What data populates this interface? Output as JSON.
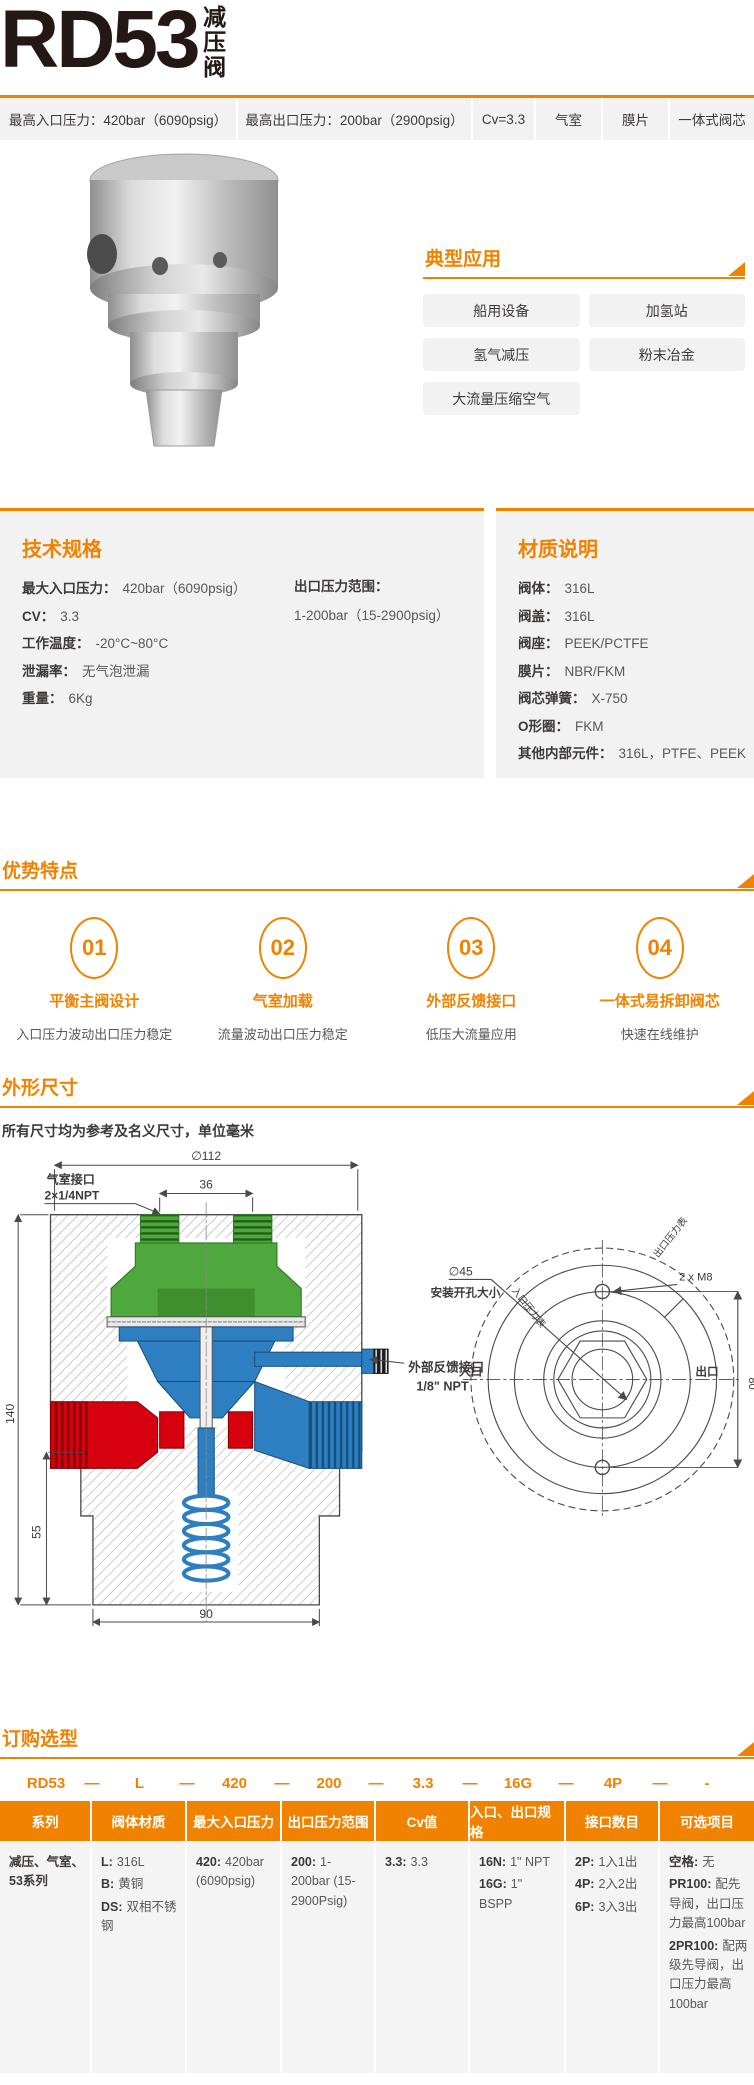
{
  "header": {
    "model": "RD53",
    "product_type": "减压阀"
  },
  "spec_bar": {
    "items": [
      "最高入口压力：420bar（6090psig）",
      "最高出口压力：200bar（2900psig）",
      "Cv=3.3",
      "气室",
      "膜片",
      "一体式阀芯"
    ]
  },
  "applications": {
    "title": "典型应用",
    "items": [
      "船用设备",
      "加氢站",
      "氢气减压",
      "粉末冶金",
      "大流量压缩空气"
    ]
  },
  "tech_specs": {
    "title": "技术规格",
    "items": [
      {
        "label": "最大入口压力：",
        "value": "420bar（6090psig）"
      },
      {
        "label": "CV：",
        "value": "3.3"
      },
      {
        "label": "工作温度：",
        "value": "-20°C~80°C"
      },
      {
        "label": "泄漏率：",
        "value": "无气泡泄漏"
      },
      {
        "label": "重量：",
        "value": "6Kg"
      }
    ],
    "outlet_range": {
      "label": "出口压力范围：",
      "value": "1-200bar（15-2900psig）"
    }
  },
  "materials": {
    "title": "材质说明",
    "items": [
      {
        "label": "阀体：",
        "value": "316L"
      },
      {
        "label": "阀盖：",
        "value": "316L"
      },
      {
        "label": "阀座：",
        "value": "PEEK/PCTFE"
      },
      {
        "label": "膜片：",
        "value": "NBR/FKM"
      },
      {
        "label": "阀芯弹簧：",
        "value": "X-750"
      },
      {
        "label": "O形圈：",
        "value": "FKM"
      },
      {
        "label": "其他内部元件：",
        "value": "316L，PTFE、PEEK"
      }
    ]
  },
  "features": {
    "title": "优势特点",
    "items": [
      {
        "num": "01",
        "label": "平衡主阀设计",
        "desc": "入口压力波动出口压力稳定"
      },
      {
        "num": "02",
        "label": "气室加载",
        "desc": "流量波动出口压力稳定"
      },
      {
        "num": "03",
        "label": "外部反馈接口",
        "desc": "低压大流量应用"
      },
      {
        "num": "04",
        "label": "一体式易拆卸阀芯",
        "desc": "快速在线维护"
      }
    ]
  },
  "dimensions": {
    "title": "外形尺寸",
    "note": "所有尺寸均为参考及名义尺寸，单位毫米",
    "drawing": {
      "dia112": "∅112",
      "dim36": "36",
      "dim140": "140",
      "dim55": "55",
      "dim90": "90",
      "dim80": "80",
      "air_port_label": "气室接口",
      "air_port_size": "2×1/4NPT",
      "feedback_label": "外部反馈接口",
      "feedback_size": "1/8\" NPT",
      "dia45": "∅45",
      "mount_hole_label": "安装开孔大小",
      "inlet": "入口",
      "outlet": "出口",
      "inlet_gauge": "入口压力表",
      "outlet_gauge": "出口压力表",
      "m8": "2 x M8"
    }
  },
  "ordering": {
    "title": "订购选型",
    "separator": "—",
    "code": [
      "RD53",
      "L",
      "420",
      "200",
      "3.3",
      "16G",
      "4P",
      "-"
    ],
    "columns": [
      {
        "header": "系列",
        "entries": [
          {
            "code": "",
            "text": "减压、气室、53系列"
          }
        ]
      },
      {
        "header": "阀体材质",
        "entries": [
          {
            "code": "L:",
            "text": "316L"
          },
          {
            "code": "B:",
            "text": "黄铜"
          },
          {
            "code": "DS:",
            "text": "双相不锈钢"
          }
        ]
      },
      {
        "header": "最大入口压力",
        "entries": [
          {
            "code": "420:",
            "text": "420bar (6090psig)"
          }
        ]
      },
      {
        "header": "出口压力范围",
        "entries": [
          {
            "code": "200:",
            "text": "1-200bar (15-2900Psig)"
          }
        ]
      },
      {
        "header": "Cv值",
        "entries": [
          {
            "code": "3.3:",
            "text": "3.3"
          }
        ]
      },
      {
        "header": "入口、出口规格",
        "entries": [
          {
            "code": "16N:",
            "text": "1\" NPT"
          },
          {
            "code": "16G:",
            "text": "1\" BSPP"
          }
        ]
      },
      {
        "header": "接口数目",
        "entries": [
          {
            "code": "2P:",
            "text": "1入1出"
          },
          {
            "code": "4P:",
            "text": "2入2出"
          },
          {
            "code": "6P:",
            "text": "3入3出"
          }
        ]
      },
      {
        "header": "可选项目",
        "entries": [
          {
            "code": "空格:",
            "text": "无"
          },
          {
            "code": "PR100:",
            "text": "配先导阀，出口压力最高100bar"
          },
          {
            "code": "2PR100:",
            "text": "配两级先导阀，出口压力最高100bar"
          }
        ]
      }
    ]
  },
  "footer": {
    "note": "有关定制规格（扩展温度范围、特殊材质、接口等），维修包，附件请联系工厂。"
  },
  "colors": {
    "accent": "#F08200",
    "panel_bg": "#F2F2F2",
    "text_dark": "#3D3A39",
    "text_gray": "#595757",
    "drawing_green": "#4FA83D",
    "drawing_red": "#D6000F",
    "drawing_blue": "#2E7FC1"
  }
}
